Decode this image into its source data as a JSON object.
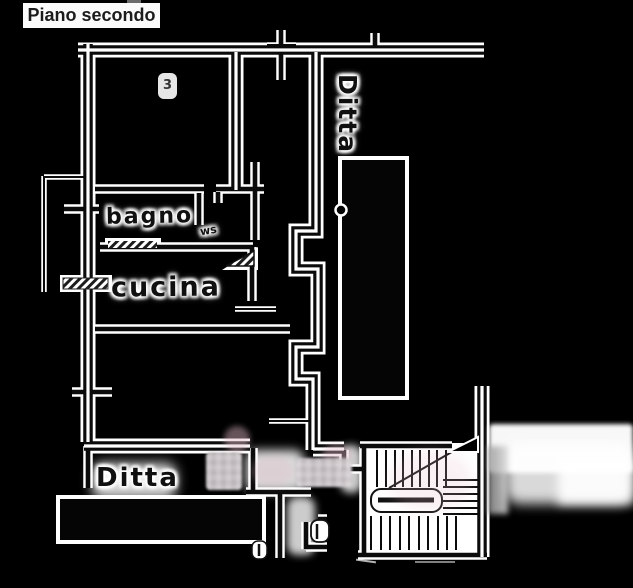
{
  "header": {
    "title": "Piano secondo"
  },
  "plan": {
    "rooms": [
      {
        "id": "bagno",
        "label": "bagno"
      },
      {
        "id": "cucina",
        "label": "cucina"
      },
      {
        "id": "ditta-right",
        "label": "Ditta"
      },
      {
        "id": "ditta-bottom",
        "label": "Ditta"
      }
    ],
    "marks": {
      "room_number": "3",
      "scribble": "ws"
    }
  },
  "colors": {
    "background": "#000000",
    "ink": "#0b0b0b",
    "paper_halo": "#ffffff",
    "title_text": "#1c1c1c",
    "title_background": "#fbfbfb",
    "redaction_gray": "#c8c1c4",
    "blur_pink": "#e2bac6"
  }
}
